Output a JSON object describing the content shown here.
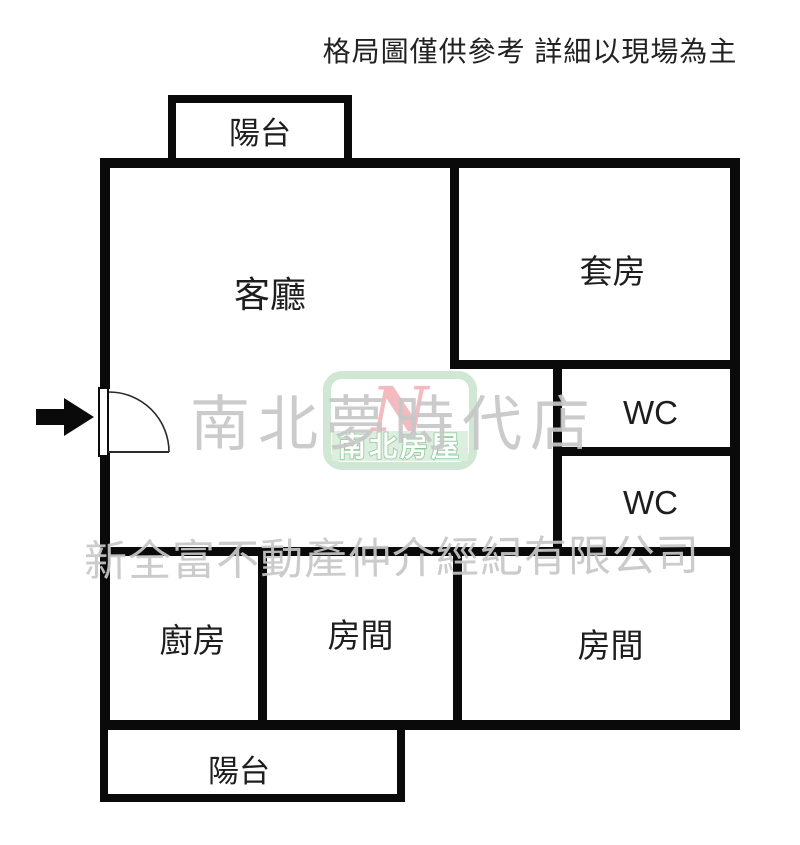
{
  "header": {
    "disclaimer": "格局圖僅供參考 詳細以現場為主"
  },
  "rooms": {
    "balcony_top": "陽台",
    "living": "客廳",
    "suite": "套房",
    "wc1": "WC",
    "wc2": "WC",
    "kitchen": "廚房",
    "room_mid": "房間",
    "room_right": "房間",
    "balcony_bottom": "陽台"
  },
  "watermark": {
    "store": "南北夢時代店",
    "company": "新全富不動產仲介經紀有限公司",
    "logo_monogram": "N",
    "logo_brand": "南北房屋"
  },
  "colors": {
    "wall": "#0a0a0a",
    "watermark_gray": "#c7c7c7",
    "logo_border_green": "#cfe7d3",
    "logo_band_green": "#dceedd",
    "logo_text_stroke_green": "#8fc79c",
    "logo_pink": "#f2b0b6"
  }
}
